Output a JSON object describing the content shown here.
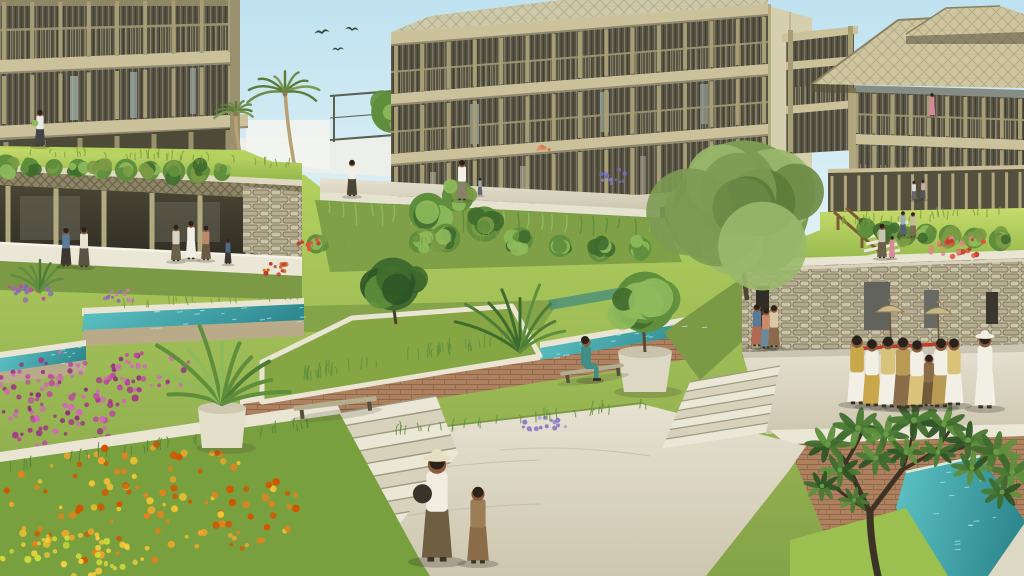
{
  "meta": {
    "title": "Terraced green-roof campus rendering",
    "type": "architectural-visualization",
    "aria_label": "Architectural rendering of a tropical terraced campus: timber buildings with slatted facades and a thatched pagoda roof, cascading green roofs, teal water channels, stone walls, flower gardens, a grand staircase, and people including a ceremonial procession with parasols"
  },
  "scene": {
    "counts": {
      "birds": 3,
      "parasols": 2,
      "procession_figures": 9,
      "palm_trees": 2
    },
    "elements": [
      {
        "name": "sky",
        "description": "pale blue tropical sky with three birds"
      },
      {
        "name": "left-building",
        "description": "timber balcony building, two storeys visible"
      },
      {
        "name": "center-building",
        "description": "three-storey timber building with vertical slat screens"
      },
      {
        "name": "right-building",
        "description": "building with two-tier thatched hip roof"
      },
      {
        "name": "pavilion",
        "description": "open green-roofed pavilion with visitors"
      },
      {
        "name": "terraces",
        "description": "cascading planted terraces and green roofs"
      },
      {
        "name": "water-channels",
        "description": "teal irrigation channels along terrace edges"
      },
      {
        "name": "stone-wall",
        "description": "stacked stone retaining wall with doorways"
      },
      {
        "name": "procession",
        "description": "ceremonial procession carrying a red pole with parasols"
      },
      {
        "name": "mother-and-child",
        "description": "woman in hat and child walking on stone path"
      },
      {
        "name": "grand-staircase",
        "description": "wide stone stairs between flower beds"
      },
      {
        "name": "flower-beds",
        "description": "magenta and orange-yellow flower gardens"
      },
      {
        "name": "frangipani-tree",
        "description": "foreground tree lower right"
      }
    ]
  },
  "palette": {
    "sky": "#bfe2f0",
    "skyLow": "#ecf6f2",
    "timber": "#a89e76",
    "timberLight": "#c6bd94",
    "timberDark": "#6b6550",
    "interior": "#4a4636",
    "interiorDark": "#35322a",
    "slab": "#cbc29c",
    "thatch": "#cfc6a0",
    "thatchLine": "#9a9172",
    "grassBright": "#aecb5a",
    "grassMid": "#8fae4d",
    "grassOlive": "#7c9a45",
    "grassDark": "#6e9140",
    "water": "#3fa9ad",
    "waterDeep": "#2f8a90",
    "waterLight": "#a8e2e0",
    "stone": "#c3bb9f",
    "stoneDark": "#6e6650",
    "brick": "#ad8160",
    "brickLine": "#8a6244",
    "path": "#d8d2bd",
    "pathLight": "#ebe7d6",
    "coping": "#e9e5d2",
    "leafDark": "#3f6b2e",
    "leafMid": "#5f8f3c",
    "leafLight": "#8fba5c",
    "trunk": "#4a3f2c",
    "skin": "#8a5a3a",
    "hair": "#2a221b",
    "white": "#f2efe4",
    "gold": "#c9a84c",
    "tan": "#c9b98a",
    "red": "#c0392b",
    "magenta": "#bb4f9e",
    "orange": "#e6821f",
    "yellow": "#f0c030",
    "lavender": "#8a7cc8",
    "teal": "#3f8f86",
    "pink": "#d88898",
    "shadow": "rgba(45,42,30,0.25)"
  }
}
